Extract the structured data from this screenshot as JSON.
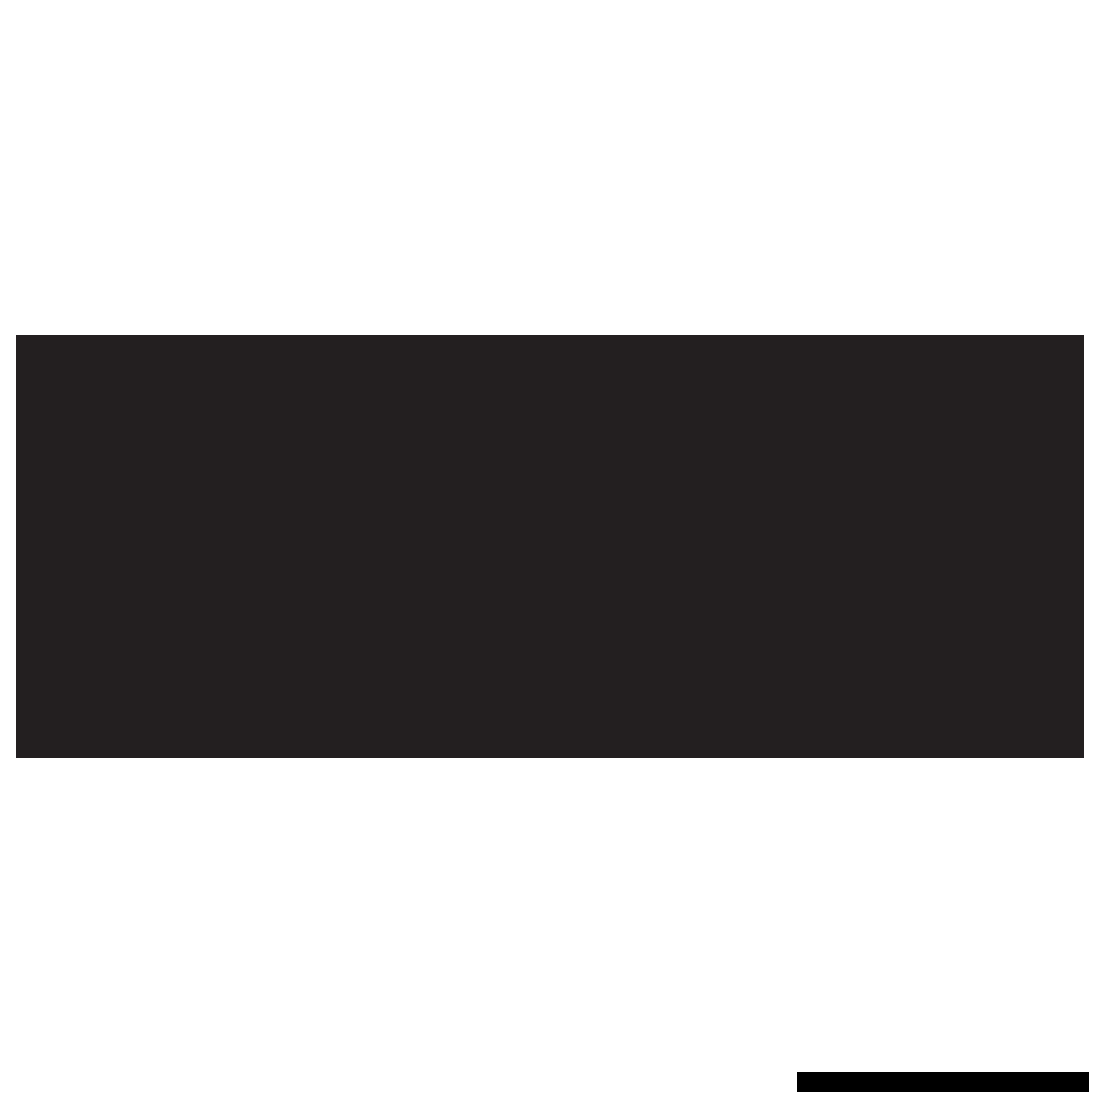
{
  "page": {
    "background_color": "#ffffff"
  },
  "banner": {
    "name": "large-dark-rectangle",
    "color": "#231f20"
  },
  "footer_bar": {
    "name": "small-black-bar",
    "color": "#000000"
  }
}
